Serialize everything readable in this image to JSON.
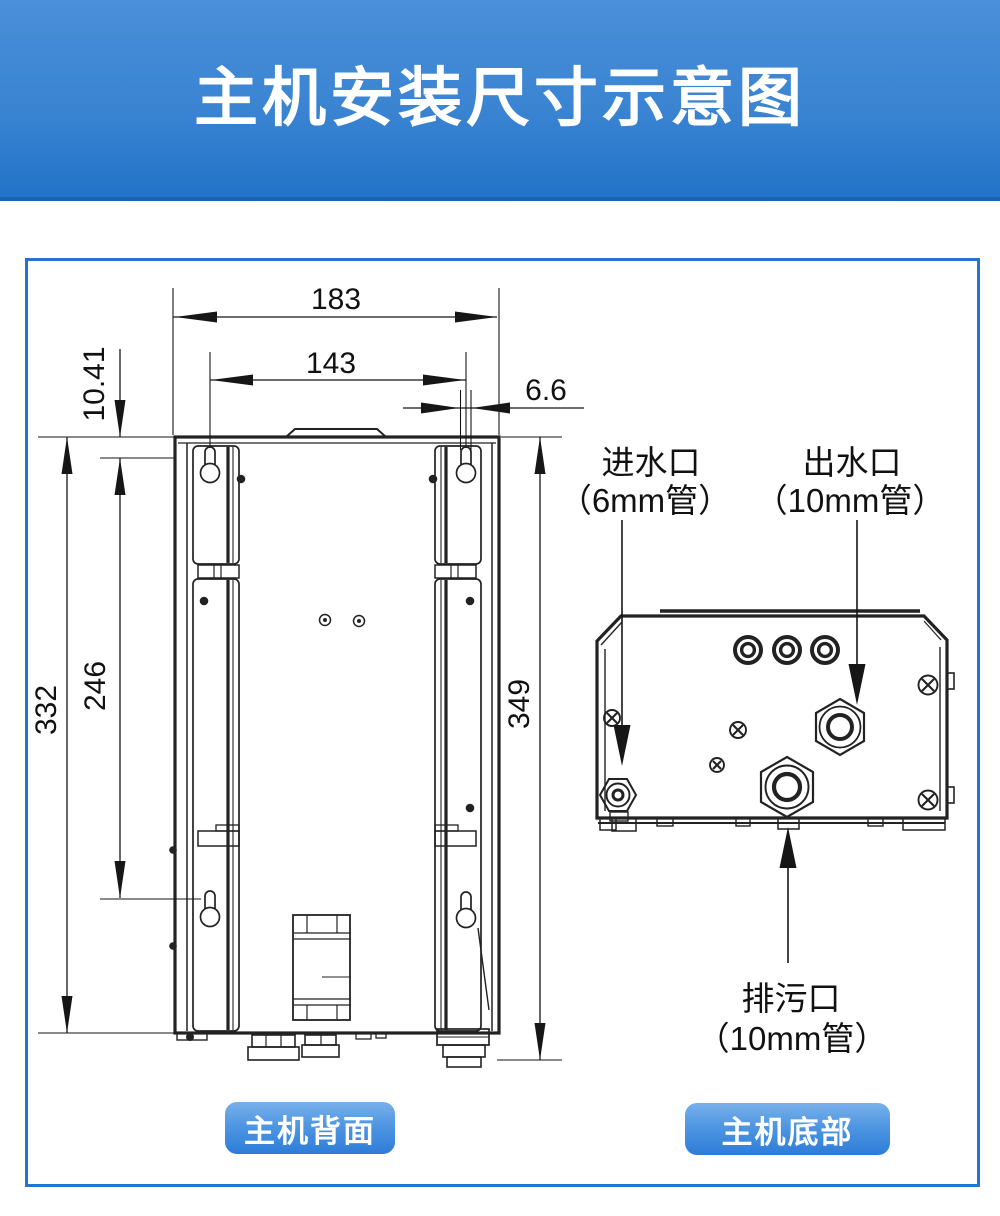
{
  "header": {
    "title": "主机安装尺寸示意图"
  },
  "back_view": {
    "caption": "主机背面",
    "dims": {
      "outer_width": "183",
      "hole_span_width": "143",
      "slot_offset": "6.6",
      "hole_top_offset": "10.41",
      "body_height": "332",
      "hole_span_height": "246",
      "overall_height": "349"
    }
  },
  "bottom_view": {
    "caption": "主机底部",
    "ports": {
      "inlet_name": "进水口",
      "inlet_pipe": "（6mm管）",
      "outlet_name": "出水口",
      "outlet_pipe": "（10mm管）",
      "drain_name": "排污口",
      "drain_pipe": "（10mm管）"
    }
  },
  "colors": {
    "header_top": "#4a8fd9",
    "header_bottom": "#2273c8",
    "frame_border": "#2574d0",
    "button_top": "#79b0ea",
    "button_bottom": "#2e7cd8",
    "drawing_line": "#222222"
  }
}
